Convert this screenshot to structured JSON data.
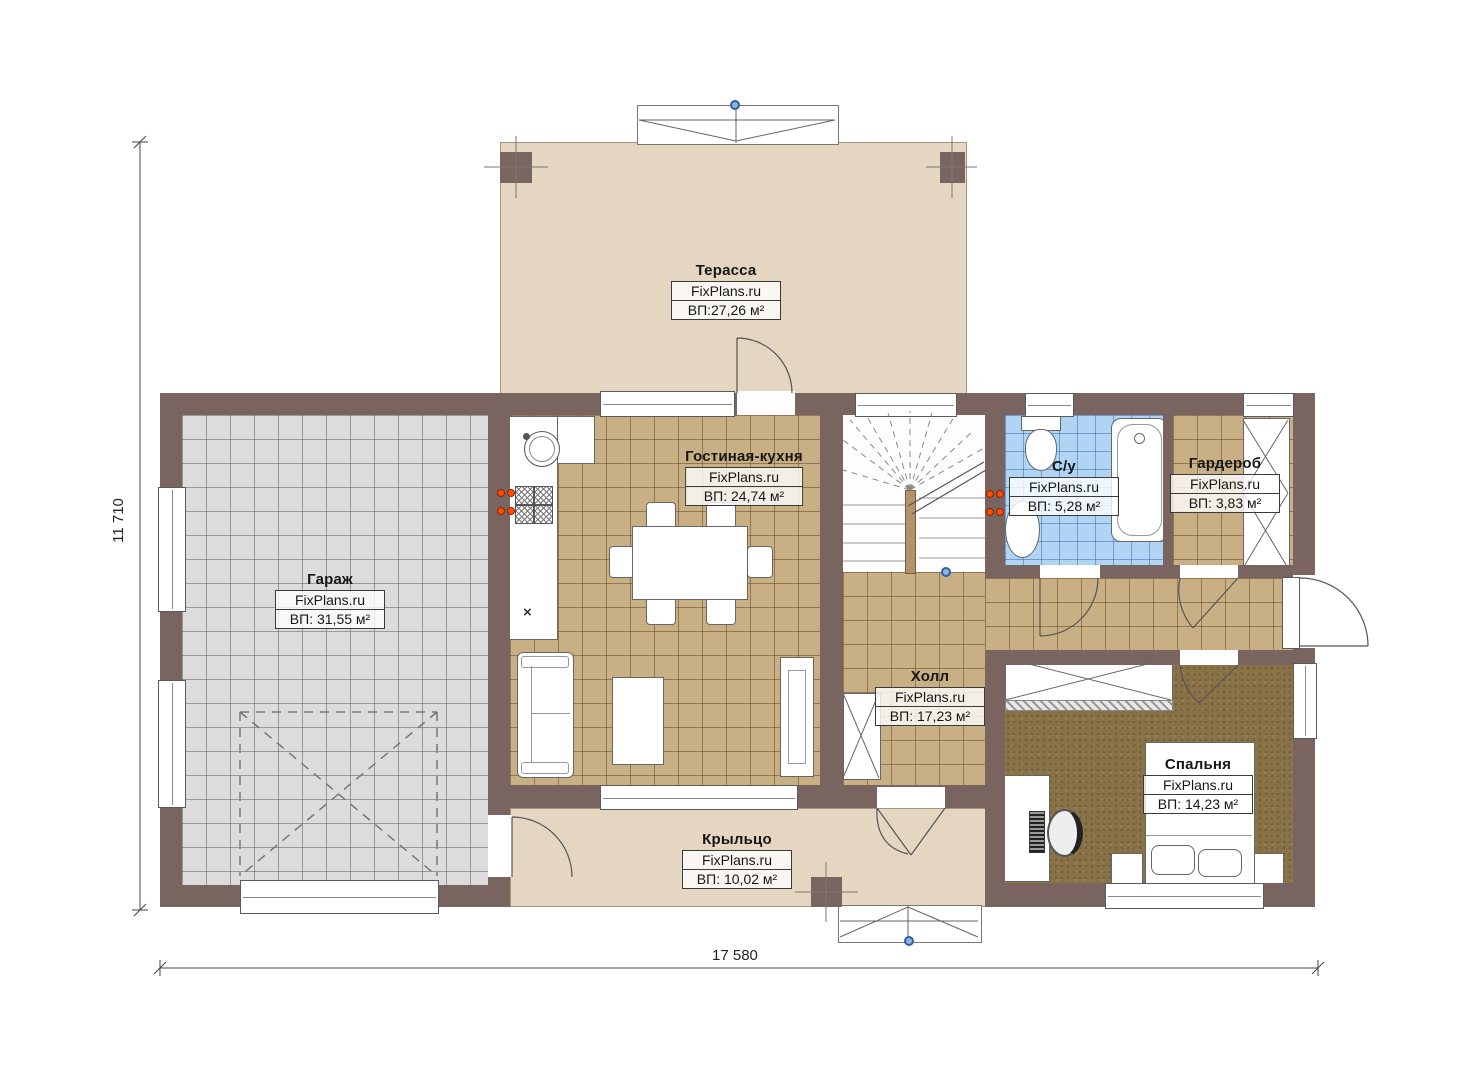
{
  "watermark": "FixPlans.ru",
  "dimensions": {
    "height_label": "11 710",
    "width_label": "17 580"
  },
  "rooms": [
    {
      "key": "terrace",
      "name": "Терасса",
      "area": "ВП:27,26 м²"
    },
    {
      "key": "garage",
      "name": "Гараж",
      "area": "ВП: 31,55 м²"
    },
    {
      "key": "living_kitchen",
      "name": "Гостиная-кухня",
      "area": "ВП: 24,74 м²"
    },
    {
      "key": "bathroom",
      "name": "С/у",
      "area": "ВП: 5,28 м²"
    },
    {
      "key": "wardrobe",
      "name": "Гардероб",
      "area": "ВП: 3,83 м²"
    },
    {
      "key": "hall",
      "name": "Холл",
      "area": "ВП: 17,23 м²"
    },
    {
      "key": "bedroom",
      "name": "Спальня",
      "area": "ВП: 14,23 м²"
    },
    {
      "key": "porch",
      "name": "Крыльцо",
      "area": "ВП: 10,02 м²"
    }
  ],
  "colors": {
    "wall": "#796460",
    "terrace_floor": "#e4d6c1",
    "garage_floor": "#dcdcdc",
    "tan_floor": "#c9b084",
    "bath_floor": "#b0d4f4",
    "bedroom_floor": "#8a7247",
    "accent_orange": "#ff4d00",
    "accent_blue": "#2f5fa3"
  }
}
